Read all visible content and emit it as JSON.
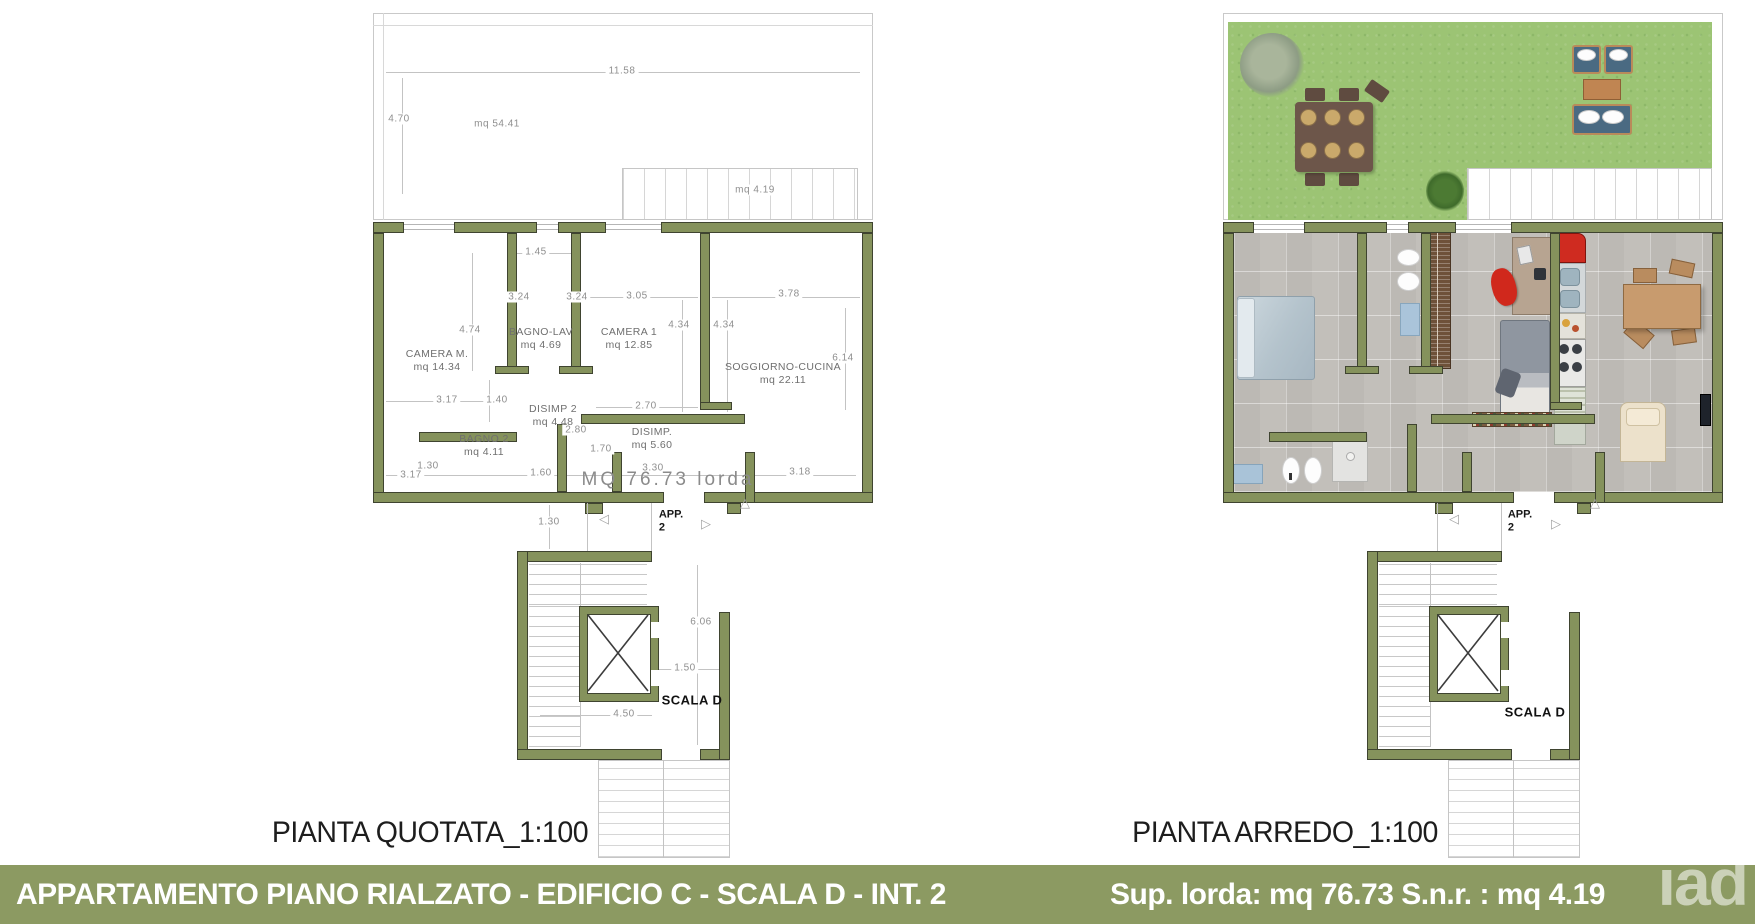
{
  "banner": {
    "title": "APPARTAMENTO PIANO RIALZATO - EDIFICIO  C - SCALA D - INT. 2",
    "stats": "Sup. lorda: mq 76.73  S.n.r. : mq 4.19",
    "watermark": "iad",
    "bg_color": "#8c9a62",
    "text_color": "#ffffff"
  },
  "colors": {
    "wall": "#85925c",
    "grass": "#9cc474",
    "tile": "#c2bfba",
    "dim_text": "#8f8f8f",
    "room_text": "#6f6f6f"
  },
  "left_plan": {
    "caption": "PIANTA QUOTATA_1:100",
    "total_label": "MQ  76.73  lorda",
    "app_line1": "APP.",
    "app_line2": "2",
    "scala_label": "SCALA D",
    "area_labels": [
      {
        "t": "mq  54.41",
        "x": 497,
        "y": 124
      },
      {
        "t": "mq  4.19",
        "x": 755,
        "y": 190
      }
    ],
    "rooms": [
      {
        "name": "CAMERA  M.",
        "area": "mq 14.34",
        "x": 437,
        "y": 361
      },
      {
        "name": "BAGNO-LAV",
        "area": "mq 4.69",
        "x": 541,
        "y": 339
      },
      {
        "name": "CAMERA  1",
        "area": "mq 12.85",
        "x": 629,
        "y": 339
      },
      {
        "name": "SOGGIORNO-CUCINA",
        "area": "mq 22.11",
        "x": 783,
        "y": 374
      },
      {
        "name": "DISIMP 2",
        "area": "mq 4.48",
        "x": 553,
        "y": 416
      },
      {
        "name": "DISIMP.",
        "area": "mq 5.60",
        "x": 652,
        "y": 439
      },
      {
        "name": "BAGNO  2",
        "area": "mq 4.11",
        "x": 484,
        "y": 446
      }
    ],
    "dimensions": [
      {
        "t": "11.58",
        "x": 622,
        "y": 71
      },
      {
        "t": "4.70",
        "x": 399,
        "y": 119
      },
      {
        "t": "1.45",
        "x": 536,
        "y": 252
      },
      {
        "t": "3.24",
        "x": 519,
        "y": 297
      },
      {
        "t": "3.24",
        "x": 577,
        "y": 297
      },
      {
        "t": "3.05",
        "x": 637,
        "y": 296
      },
      {
        "t": "3.78",
        "x": 789,
        "y": 294
      },
      {
        "t": "4.74",
        "x": 470,
        "y": 330
      },
      {
        "t": "4.34",
        "x": 679,
        "y": 325
      },
      {
        "t": "4.34",
        "x": 724,
        "y": 325
      },
      {
        "t": "6.14",
        "x": 843,
        "y": 358
      },
      {
        "t": "3.17",
        "x": 447,
        "y": 400
      },
      {
        "t": "1.40",
        "x": 497,
        "y": 400
      },
      {
        "t": "2.70",
        "x": 646,
        "y": 406
      },
      {
        "t": "2.80",
        "x": 576,
        "y": 430
      },
      {
        "t": "1.70",
        "x": 601,
        "y": 449
      },
      {
        "t": "1.30",
        "x": 428,
        "y": 466
      },
      {
        "t": "3.17",
        "x": 411,
        "y": 475
      },
      {
        "t": "1.60",
        "x": 541,
        "y": 473
      },
      {
        "t": "3.30",
        "x": 653,
        "y": 468
      },
      {
        "t": "3.18",
        "x": 800,
        "y": 472
      },
      {
        "t": "1.30",
        "x": 549,
        "y": 522
      },
      {
        "t": "6.06",
        "x": 701,
        "y": 622
      },
      {
        "t": "1.50",
        "x": 685,
        "y": 668
      },
      {
        "t": "4.50",
        "x": 624,
        "y": 714
      }
    ]
  },
  "right_plan": {
    "caption": "PIANTA ARREDO_1:100",
    "app_line1": "APP.",
    "app_line2": "2",
    "scala_label": "SCALA D"
  }
}
